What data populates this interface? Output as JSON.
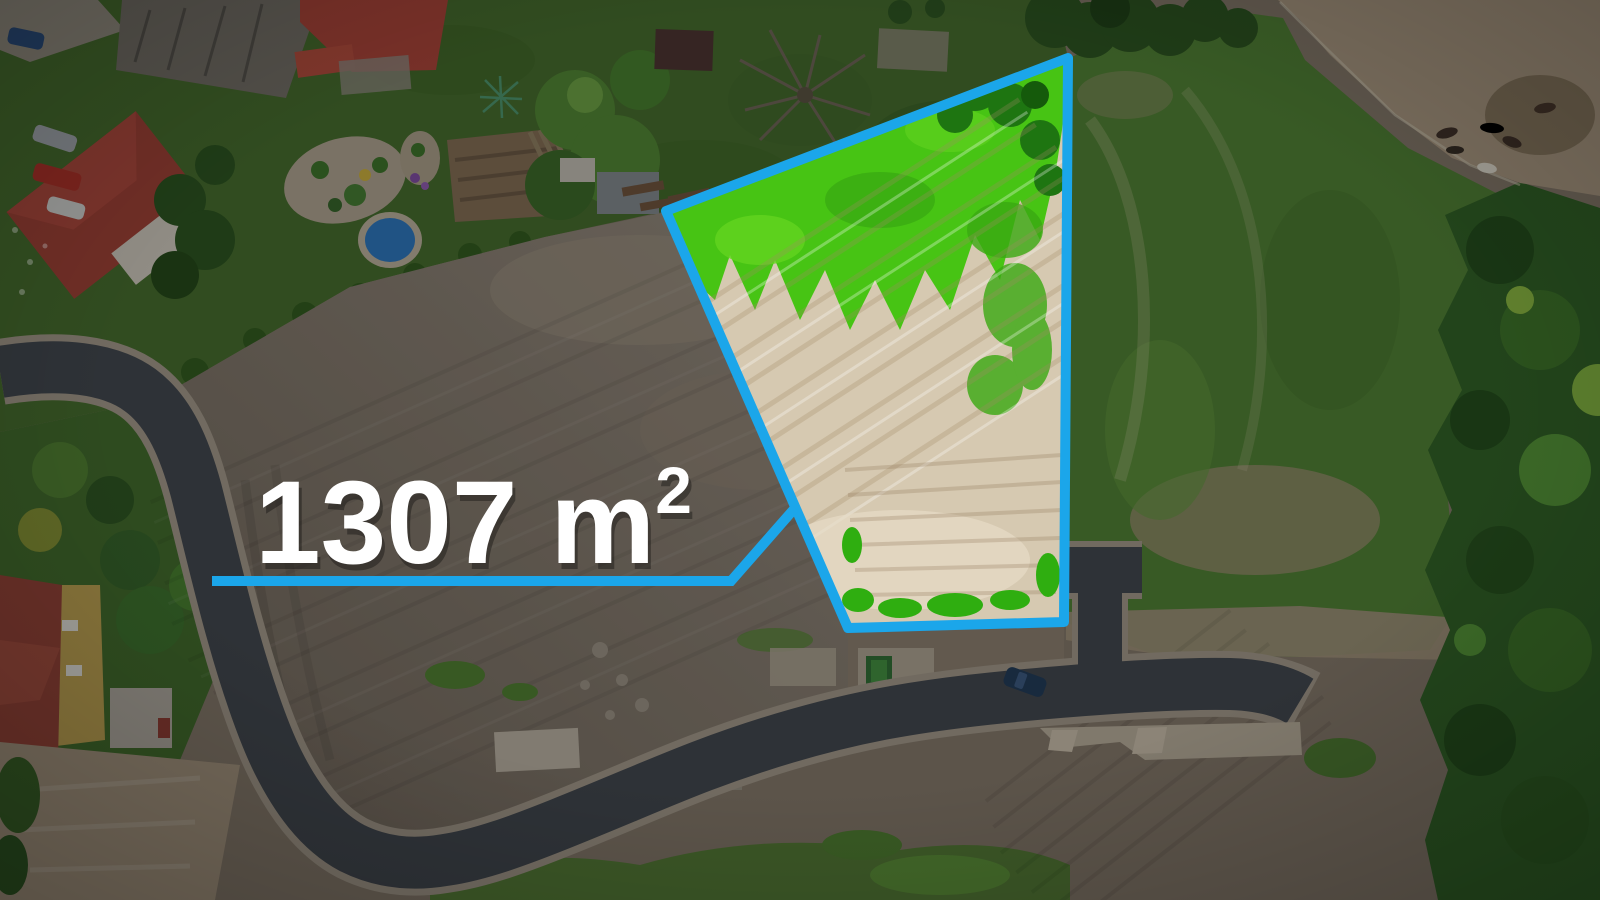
{
  "annotation": {
    "area_main": "1307 m",
    "area_exponent": "2",
    "area_label_full": "1307 m²",
    "accent_color": "#1ba6ea",
    "label_color": "#ffffff"
  },
  "palette": {
    "plot_sand": "#d6c9b1",
    "plot_grass": "#47c414",
    "meadow_green": "#4e7c33",
    "forest_green": "#2f5e25",
    "paddock_sand": "#a3937d",
    "garden_lawn": "#44692c",
    "field_light": "#90867a",
    "field_dark": "#6a6156",
    "bottom_dirt": "#7e7366",
    "road_asphalt": "#40454c",
    "road_shoulder": "#9b9284",
    "dim_overlay": "rgba(0,0,0,0.27)"
  }
}
